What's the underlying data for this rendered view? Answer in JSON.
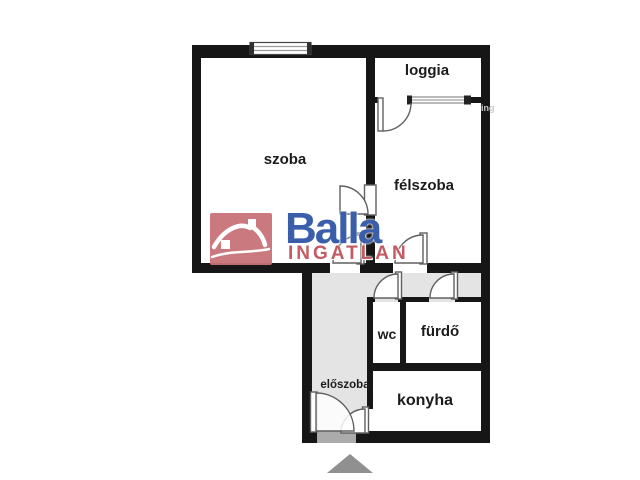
{
  "plan": {
    "type": "apartment-floor-plan",
    "rooms": {
      "szoba": {
        "label": "szoba"
      },
      "loggia": {
        "label": "loggia"
      },
      "felszoba": {
        "label": "félszoba"
      },
      "wc": {
        "label": "wc"
      },
      "furdo": {
        "label": "fürdő"
      },
      "konyha": {
        "label": "konyha"
      },
      "eloszoba": {
        "label": "előszoba"
      }
    }
  },
  "logo": {
    "brand": "Balla",
    "subtitle": "INGATLAN",
    "icon": "house-icon",
    "brand_color": "#3a5ea9",
    "subtitle_color": "#c25b62",
    "icon_bg_color": "#c87379"
  },
  "watermark_fragment": {
    "text": "ing"
  },
  "marker": {
    "shape": "triangle-up",
    "color": "#909090"
  },
  "colors": {
    "wall": "#161616",
    "corridor_floor": "#e4e4e4",
    "room_floor": "#ffffff",
    "door_stroke": "#606060",
    "window_stroke": "#8a8a8a",
    "background": "#ffffff"
  }
}
